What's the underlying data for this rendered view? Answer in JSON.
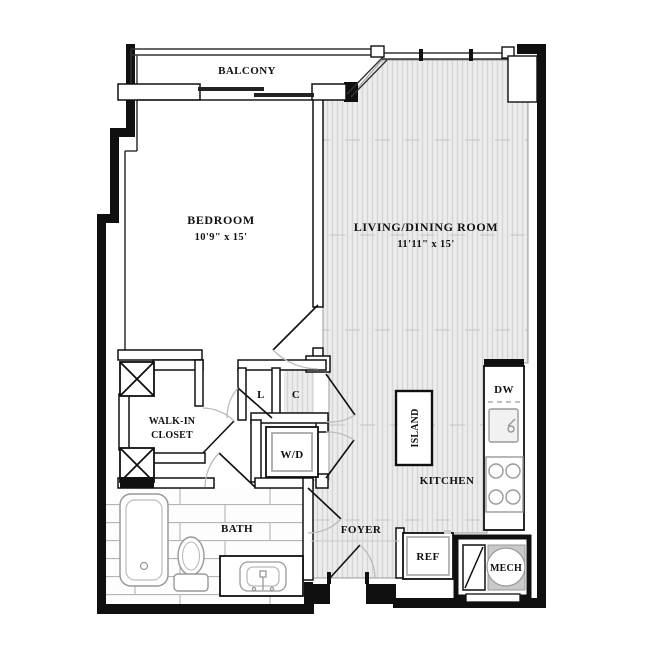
{
  "rooms": {
    "balcony": {
      "label": "BALCONY"
    },
    "bedroom": {
      "label": "BEDROOM",
      "dims": "10'9\" x 15'"
    },
    "living_dining": {
      "label": "LIVING/DINING ROOM",
      "dims": "11'11\" x 15'"
    },
    "walk_in_closet": {
      "label_line1": "WALK-IN",
      "label_line2": "CLOSET"
    },
    "bath": {
      "label": "BATH"
    },
    "foyer": {
      "label": "FOYER"
    },
    "kitchen": {
      "label": "KITCHEN"
    }
  },
  "fixtures": {
    "island": {
      "label": "ISLAND"
    },
    "dishwasher": {
      "label": "DW"
    },
    "refrigerator": {
      "label": "REF"
    },
    "mechanical": {
      "label": "MECH"
    },
    "washer_dryer": {
      "label": "W/D"
    },
    "linen_closet": {
      "label": "L"
    },
    "coat_closet": {
      "label": "C"
    }
  },
  "colors": {
    "wall": "#101010",
    "wood_floor_base": "#ececec",
    "wood_floor_stripe": "#d5d5d5",
    "tile_line": "#b5b5b5",
    "fixture_outline": "#999999",
    "door_arc": "#bbbbbb",
    "mech_gray": "#c9c9c9"
  }
}
